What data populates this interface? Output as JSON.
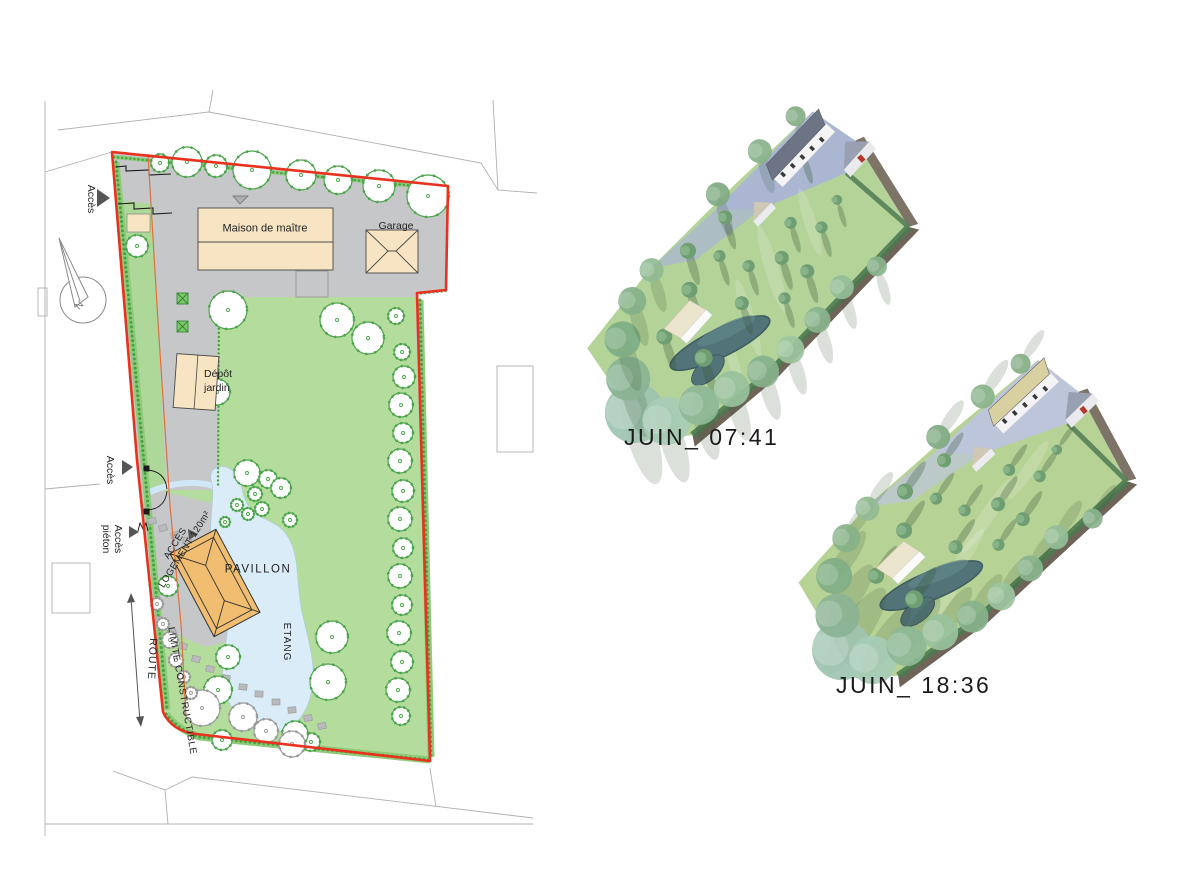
{
  "site_plan": {
    "buildings": {
      "maison": "Maison de maître",
      "garage": "Garage",
      "depot": "Dépôt\njardin",
      "pavillon": "PAVILLON"
    },
    "water": {
      "etang": "ETANG"
    },
    "access": {
      "top": "Accès",
      "middle": "Accès",
      "pedestrian": "Accès\npiéton",
      "road": "ROUTE",
      "logement": "ACCÈS\nLOGEMENT 120m²",
      "limite": "LIMITE CONSTRUCTIBLE"
    },
    "compass_n": "N"
  },
  "renders": {
    "morning_label": "JUIN_ 07:41",
    "evening_label": "JUIN_ 18:36"
  },
  "colors": {
    "boundary_red": "#e8321e",
    "lawn_green": "#b4dc9c",
    "pond_blue": "#d9ecf8",
    "building_beige": "#f7e4c3",
    "pavilion_orange": "#f1bd70",
    "courtyard_gray": "#c6c7c9",
    "hedge_green": "#8fca78",
    "hedge_dark": "#47a247",
    "limit_orange": "#e2703a"
  }
}
